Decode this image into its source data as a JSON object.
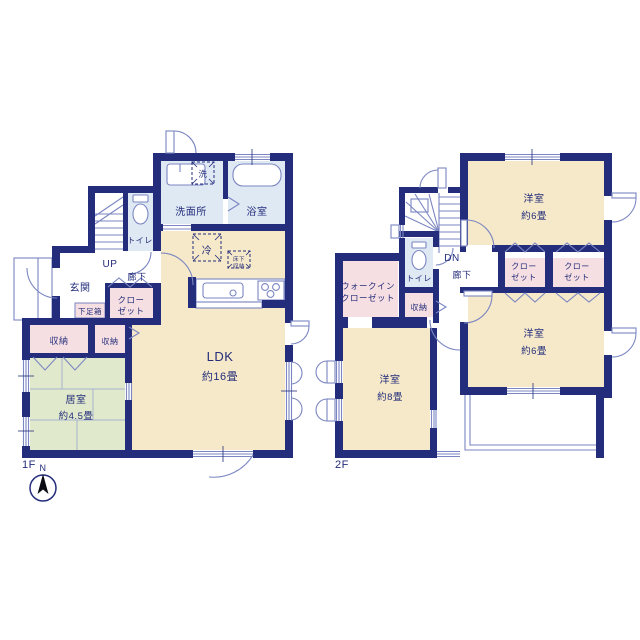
{
  "colors": {
    "wall": "#232d7b",
    "room_cream": "#f6e9c9",
    "room_blue": "#dfe9f4",
    "room_pink": "#f6dfe2",
    "room_green": "#e0e9cb",
    "thin_line": "#7b86c2",
    "text": "#232d7b"
  },
  "floor1": {
    "label": "1F",
    "rooms": {
      "washroom": {
        "name": "洗面所"
      },
      "bath": {
        "name": "浴室"
      },
      "washer": {
        "name": "洗"
      },
      "toilet": {
        "name": "トイレ"
      },
      "entrance": {
        "name": "玄関"
      },
      "stairs_up": {
        "name": "UP"
      },
      "hallway": {
        "name": "廊下"
      },
      "closet": {
        "line1": "クロー",
        "line2": "ゼット"
      },
      "shoe_box": {
        "name": "下足箱"
      },
      "storage_left": {
        "name": "収納"
      },
      "storage_right": {
        "name": "収納"
      },
      "tatami_room": {
        "name": "居室",
        "size": "約4.5畳"
      },
      "ldk": {
        "name": "LDK",
        "size": "約16畳"
      },
      "fridge": {
        "name": "冷"
      },
      "underfloor": {
        "line1": "床下",
        "line2": "収納"
      }
    }
  },
  "floor2": {
    "label": "2F",
    "rooms": {
      "room_top": {
        "name": "洋室",
        "size": "約6畳"
      },
      "room_right": {
        "name": "洋室",
        "size": "約6畳"
      },
      "room_left": {
        "name": "洋室",
        "size": "約8畳"
      },
      "walk_in_closet": {
        "line1": "ウォークイン",
        "line2": "クローゼット"
      },
      "closet_a": {
        "line1": "クロー",
        "line2": "ゼット"
      },
      "closet_b": {
        "line1": "クロー",
        "line2": "ゼット"
      },
      "storage": {
        "name": "収納"
      },
      "toilet": {
        "name": "トイレ"
      },
      "stairs_dn": {
        "name": "DN"
      },
      "hallway": {
        "name": "廊下"
      }
    }
  },
  "compass": {
    "label": "N"
  }
}
